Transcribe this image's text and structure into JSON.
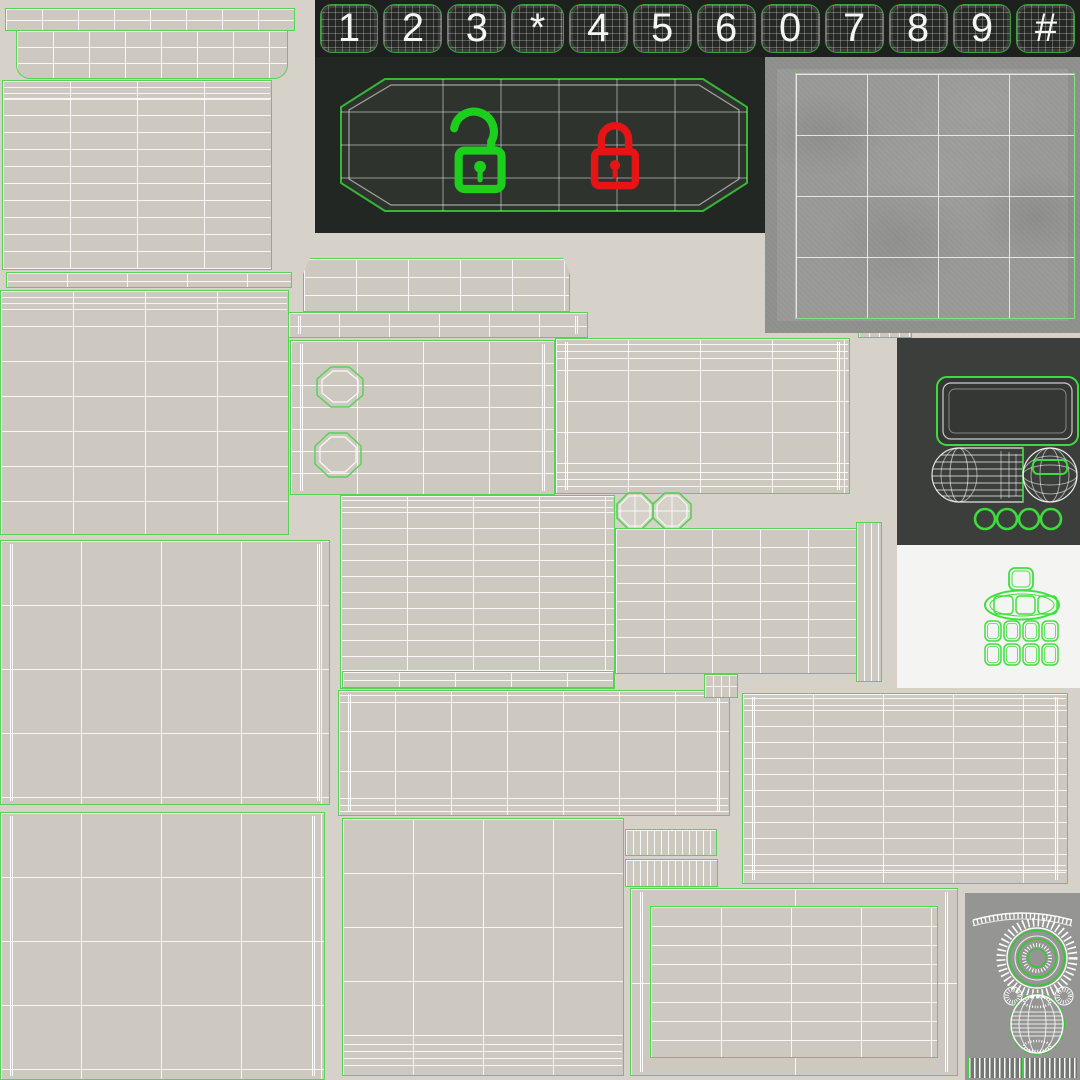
{
  "atlas": {
    "title": "keypad-lock-uv-texture-atlas",
    "keypad": {
      "keys": [
        "1",
        "2",
        "3",
        "*",
        "4",
        "5",
        "6",
        "0",
        "7",
        "8",
        "9",
        "#"
      ]
    },
    "indicators": {
      "unlocked": {
        "icon": "unlocked-padlock-icon",
        "state": "unlocked",
        "color": "#1dcf1d"
      },
      "locked": {
        "icon": "locked-padlock-icon",
        "state": "locked",
        "color": "#e61414"
      }
    },
    "regions": [
      "keypad-strip",
      "lock-display-panel",
      "concrete-texture-swatch",
      "dark-parts-panel",
      "white-keys-panel",
      "gray-dial-panel",
      "uv-wireframe-patches"
    ],
    "colors": {
      "background": "#d6d2c9",
      "patch_fill": "#cdc9c0",
      "wireframe_white": "#ffffff",
      "uv_outline_green": "#54d354",
      "keypad_background": "#1e201e",
      "key_outline_green": "#3f9e3f",
      "display_background": "#232723",
      "display_screen": "#2f342e",
      "side_panel_background": "#3b3e3b",
      "white_panel_background": "#f4f4f2",
      "gray_panel_background": "#959593",
      "concrete_gray": "#9b9b99"
    }
  }
}
